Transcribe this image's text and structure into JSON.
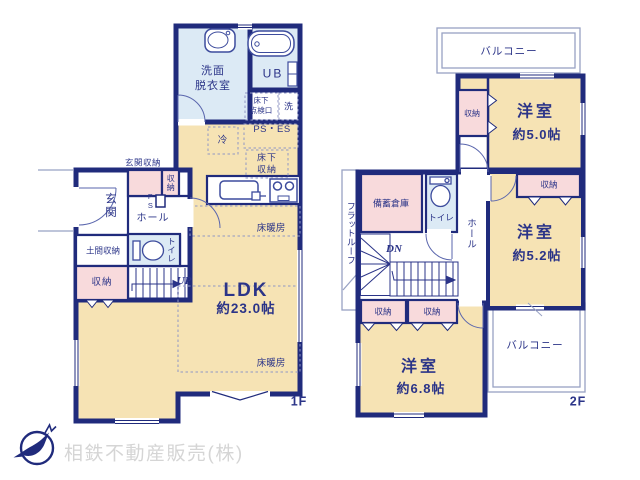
{
  "colors": {
    "wall_navy": "#202b7c",
    "text_navy": "#2b3488",
    "room_cream": "#f6e3b4",
    "closet_pink": "#f8dadc",
    "bath_blue": "#dceaf5",
    "company_gray": "#d5d5d5"
  },
  "floor1": {
    "floor_label": "1F",
    "ldk_name": "LDK",
    "ldk_size": "約23.0帖",
    "washroom_line1": "洗面",
    "washroom_line2": "脱衣室",
    "unit_bath": "UB",
    "underfloor_hatch_line1": "床下",
    "underfloor_hatch_line2": "点検口",
    "washer": "洗",
    "ps_es": "PS・ES",
    "fridge": "冷",
    "underfloor_storage_line1": "床下",
    "underfloor_storage_line2": "収納",
    "entrance_storage": "玄関収納",
    "storage": "収納",
    "pipe_space": "PS",
    "entrance": "玄関",
    "hall": "ホール",
    "doma_storage": "土間収納",
    "toilet": "トイレ",
    "up": "UP",
    "floor_heating": "床暖房"
  },
  "floor2": {
    "floor_label": "2F",
    "balcony": "バルコニー",
    "storage": "収納",
    "room_5_0_name": "洋室",
    "room_5_0_size": "約5.0帖",
    "room_5_2_name": "洋室",
    "room_5_2_size": "約5.2帖",
    "room_6_8_name": "洋室",
    "room_6_8_size": "約6.8帖",
    "stock_storage": "備蓄倉庫",
    "toilet": "トイレ",
    "hall": "ホール",
    "flat_roof": "フラットルーフ",
    "down": "DN"
  },
  "footer": {
    "company": "相鉄不動産販売(株)"
  }
}
